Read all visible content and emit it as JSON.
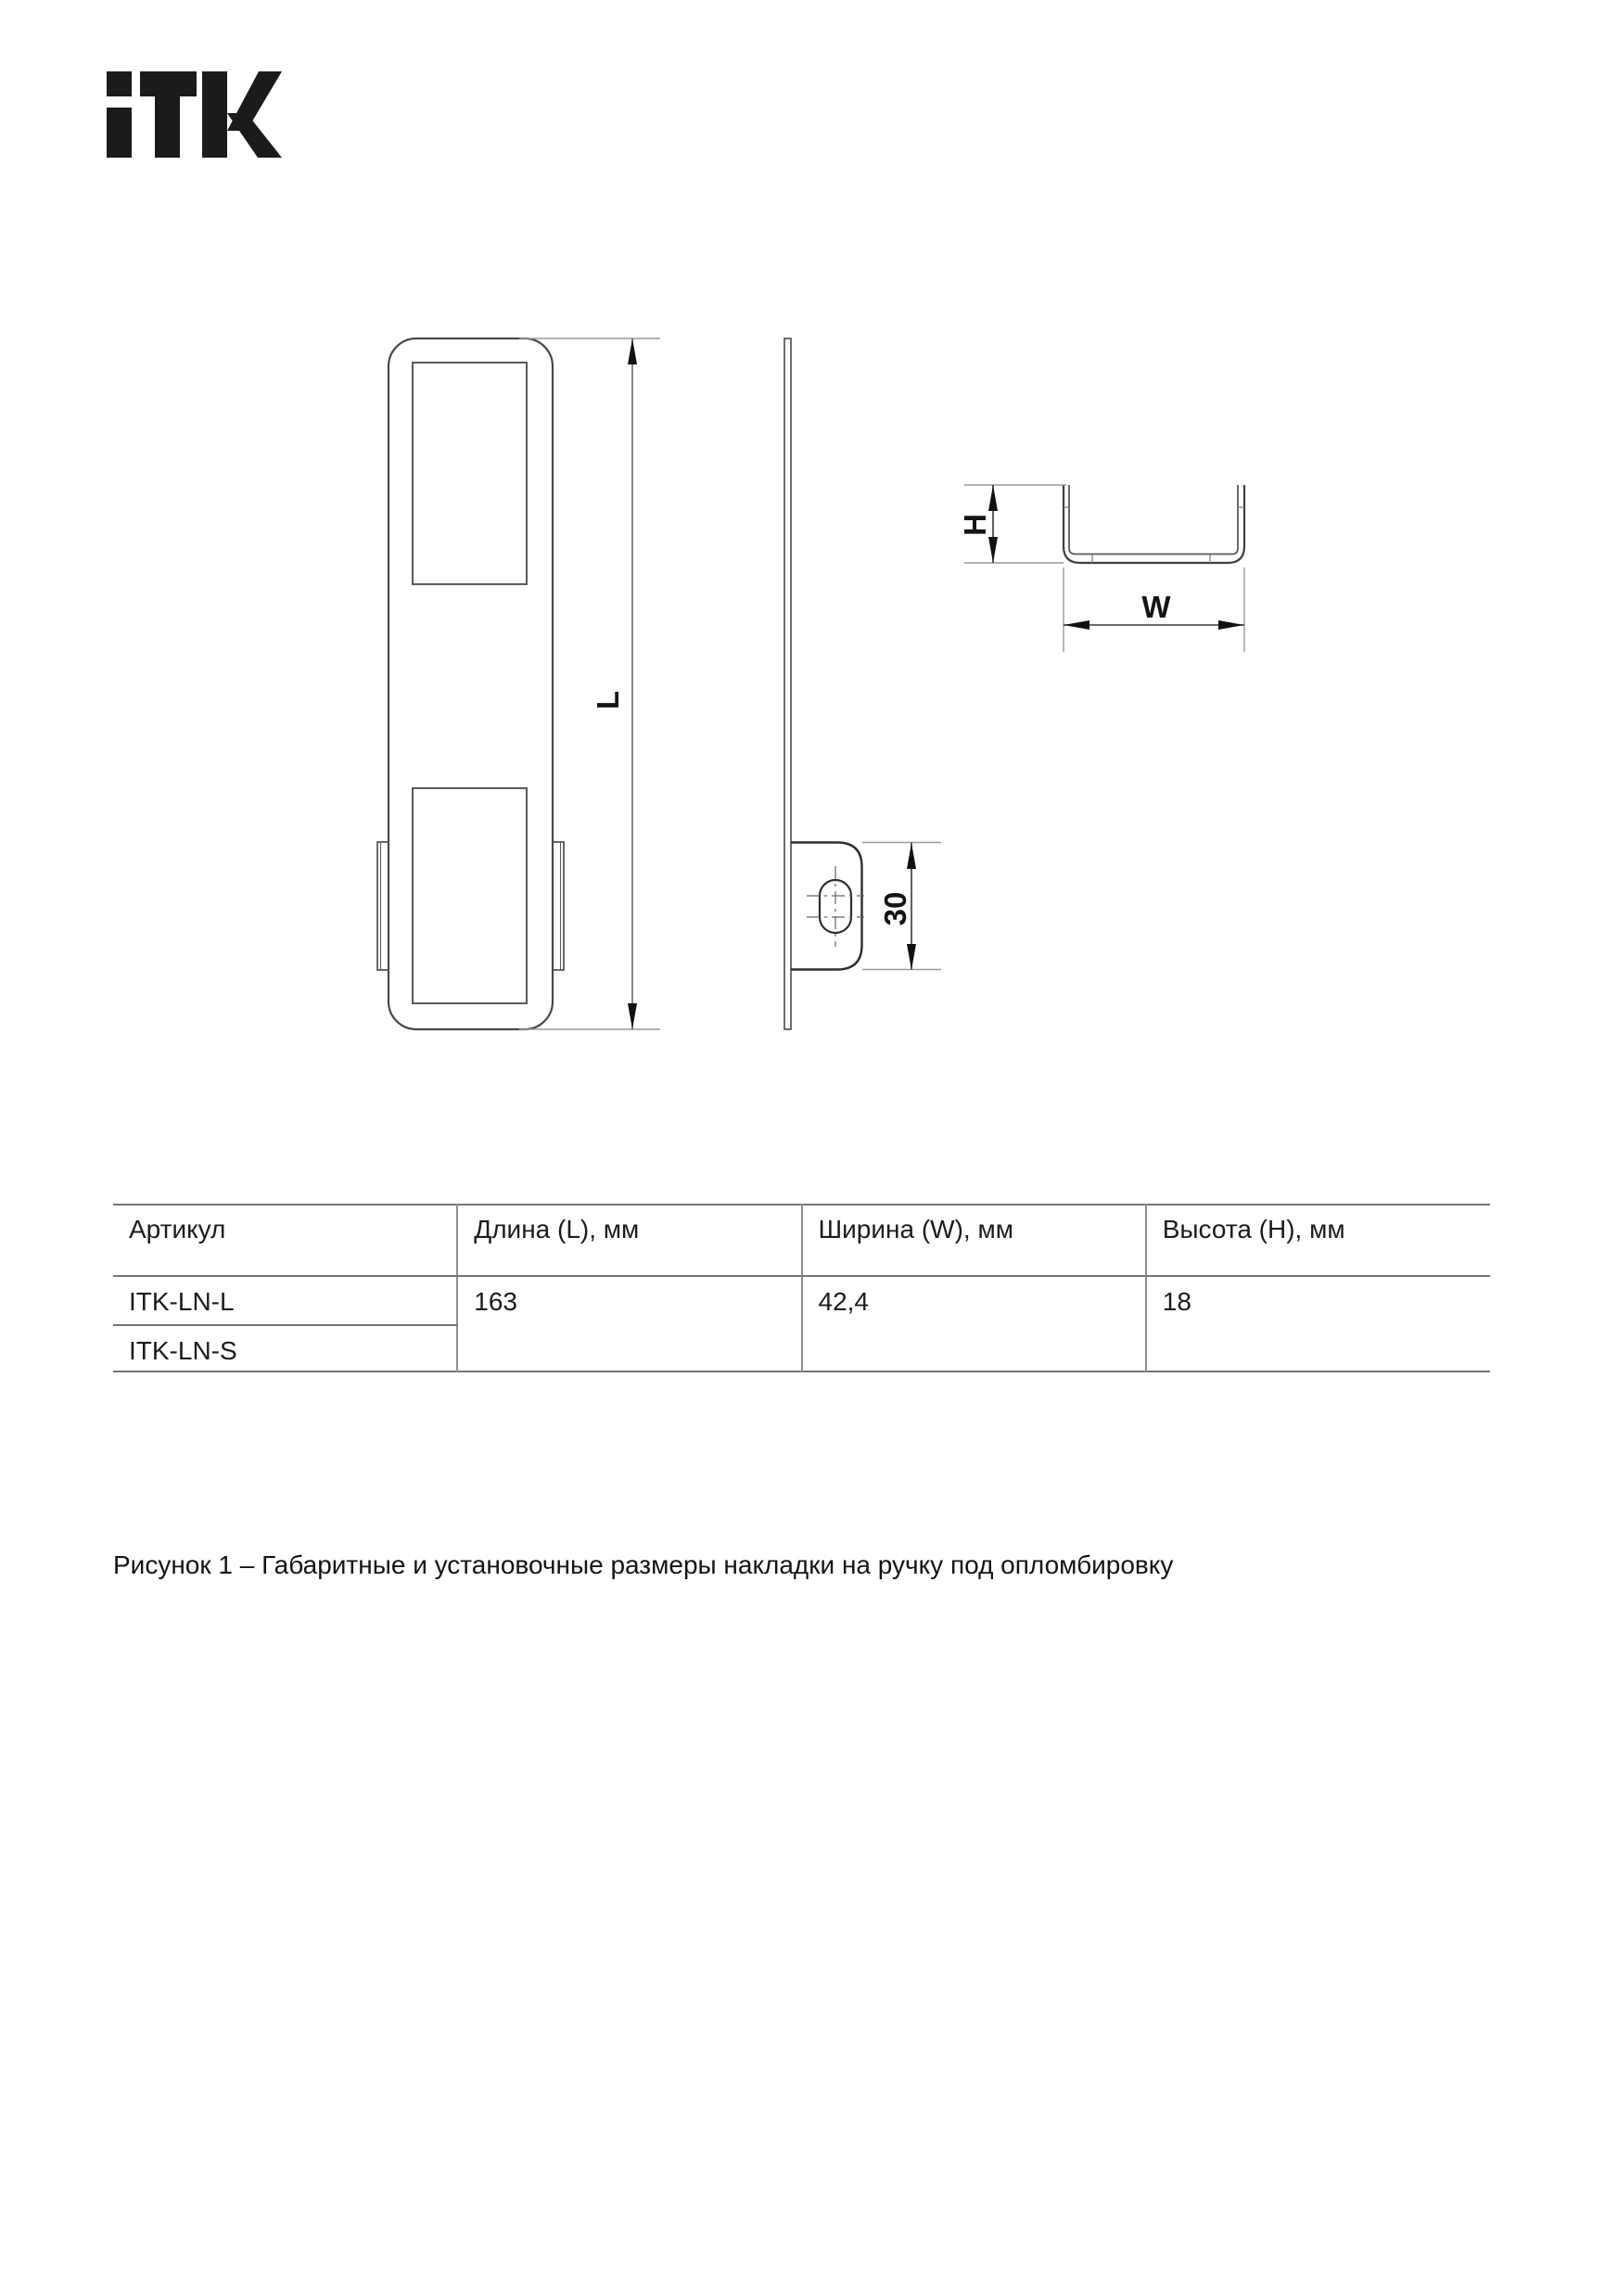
{
  "logo": {
    "text": "iTK"
  },
  "drawing": {
    "label_L": "L",
    "label_30": "30",
    "label_H": "H",
    "label_W": "W"
  },
  "table": {
    "headers": [
      "Артикул",
      "Длина (L), мм",
      "Ширина (W), мм",
      "Высота (H), мм"
    ],
    "articles": [
      "ITK-LN-L",
      "ITK-LN-S"
    ],
    "values": {
      "length": "163",
      "width": "42,4",
      "height": "18"
    }
  },
  "caption": "Рисунок 1 – Габаритные и установочные размеры накладки на ручку под опломбировку"
}
